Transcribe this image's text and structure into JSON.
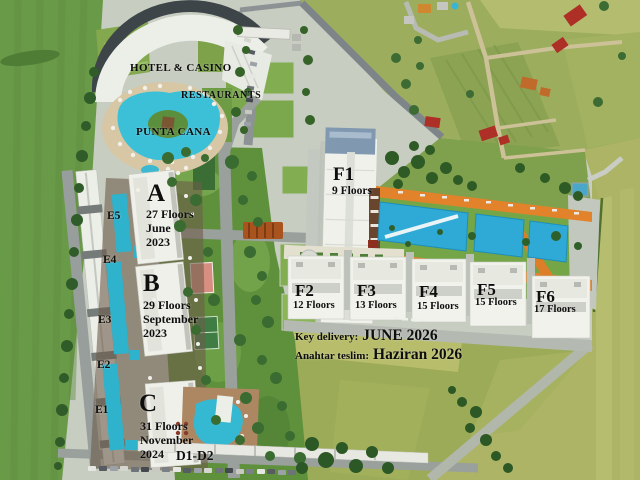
{
  "site": {
    "hotel_casino_label": "HOTEL & CASINO",
    "restaurants_label": "RESTAURANTS",
    "punta_cana_label": "PUNTA CANA",
    "d_block_label": "D1-D2"
  },
  "towers": [
    {
      "id": "A",
      "floors": "27 Floors",
      "month": "June",
      "year": "2023"
    },
    {
      "id": "B",
      "floors": "29 Floors",
      "month": "September",
      "year": "2023"
    },
    {
      "id": "C",
      "floors": "31 Floors",
      "month": "November",
      "year": "2024"
    }
  ],
  "f_blocks": [
    {
      "id": "F1",
      "floors": "9 Floors"
    },
    {
      "id": "F2",
      "floors": "12 Floors"
    },
    {
      "id": "F3",
      "floors": "13 Floors"
    },
    {
      "id": "F4",
      "floors": "15 Floors"
    },
    {
      "id": "F5",
      "floors": "15 Floors"
    },
    {
      "id": "F6",
      "floors": "17 Floors"
    }
  ],
  "e_blocks": [
    "E5",
    "E4",
    "E3",
    "E2",
    "E1"
  ],
  "delivery_note": {
    "en_label": "Key delivery:",
    "en_value": "JUNE 2026",
    "tr_label": "Anahtar teslim:",
    "tr_value": "Haziran 2026"
  },
  "palette": {
    "pool_blue": "#35b8d4",
    "deck_orange": "#e0812c",
    "field_green": "#699a47",
    "farm_yellow_green": "#adb466",
    "building_white": "#f1f2ec"
  }
}
